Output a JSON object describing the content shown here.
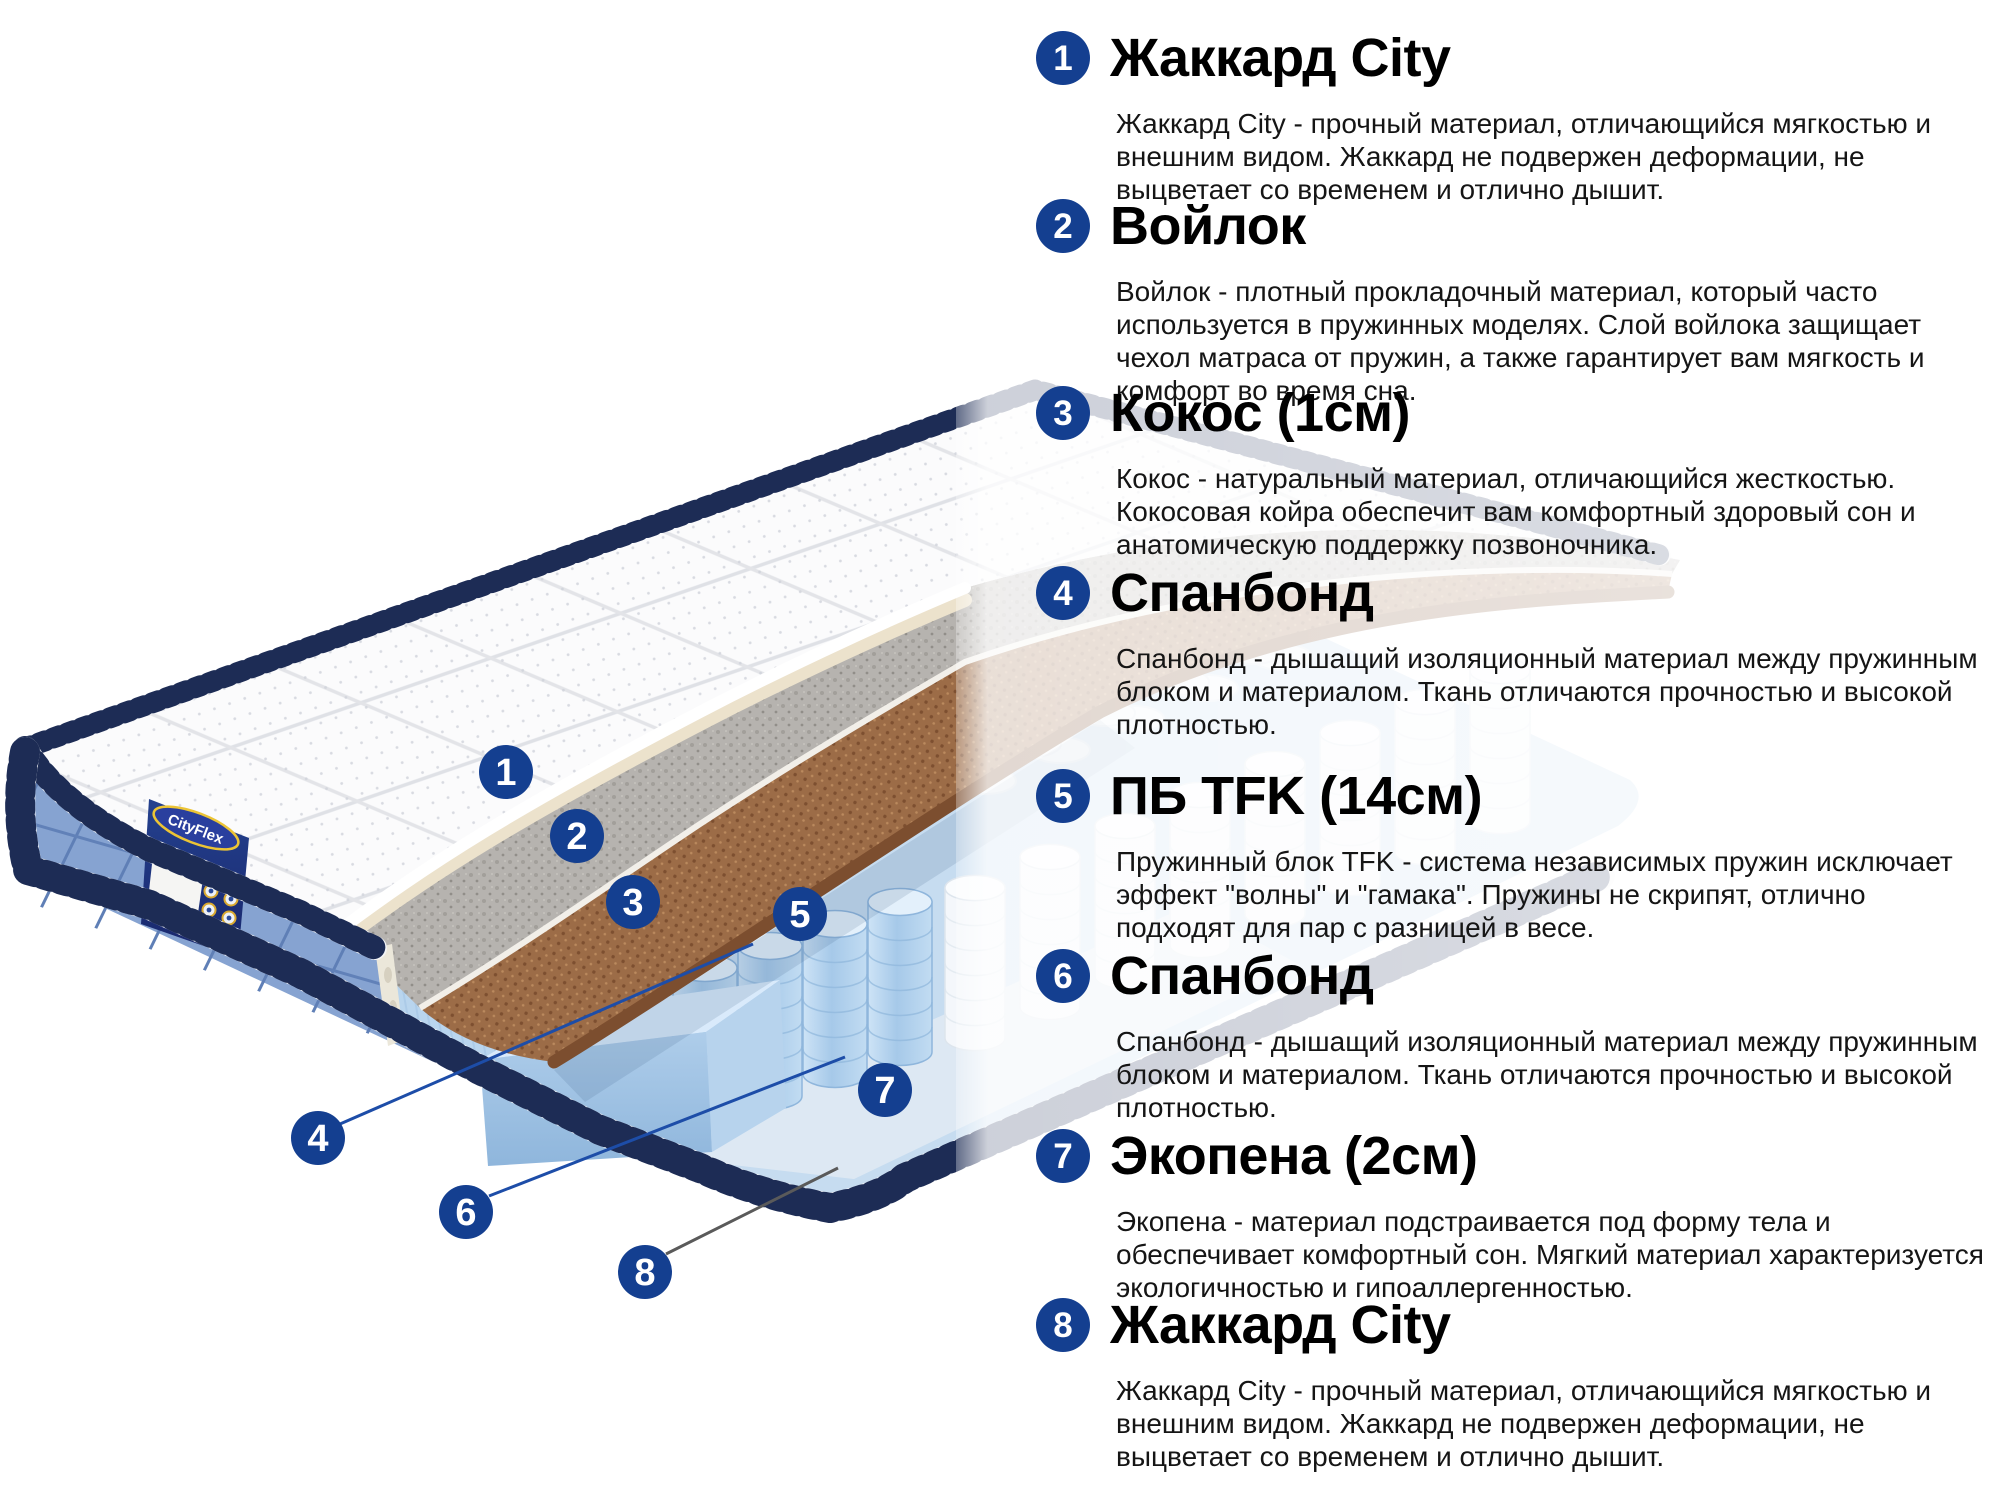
{
  "accent_color": "#143f90",
  "illustration": {
    "brand": "CityFlex",
    "type": "mattress-layer-cutaway",
    "leader_line_blue": "#1d4da8",
    "leader_line_gray": "#5a5a5a",
    "markers": [
      {
        "number": "1",
        "target_layer": "quilted-top-cover"
      },
      {
        "number": "2",
        "target_layer": "felt-layer"
      },
      {
        "number": "3",
        "target_layer": "coconut-coir-layer"
      },
      {
        "number": "4",
        "target_layer": "spunbond-above-springs"
      },
      {
        "number": "5",
        "target_layer": "pocket-spring-block"
      },
      {
        "number": "6",
        "target_layer": "spunbond-below-springs"
      },
      {
        "number": "7",
        "target_layer": "ecofoam-base-layer"
      },
      {
        "number": "8",
        "target_layer": "bottom-jacquard-cover"
      }
    ]
  },
  "legend": {
    "items": [
      {
        "number": "1",
        "title": "Жаккард City",
        "description": "Жаккард City - прочный материал, отличающийся мягкостью и внешним видом. Жаккард не подвержен деформации, не выцветает со временем и отлично дышит."
      },
      {
        "number": "2",
        "title": "Войлок",
        "description": "Войлок - плотный прокладочный материал, который часто используется в пружинных моделях. Слой войлока защищает чехол матраса от пружин, а также гарантирует вам мягкость и комфорт во время сна."
      },
      {
        "number": "3",
        "title": "Кокос (1см)",
        "description": "Кокос - натуральный материал, отличающийся жесткостью. Кокосовая койра обеспечит вам комфортный здоровый сон и анатомическую поддержку позвоночника."
      },
      {
        "number": "4",
        "title": "Спанбонд",
        "description": "Спанбонд - дышащий изоляционный материал между пружинным блоком и материалом. Ткань отличаются прочностью и высокой плотностью."
      },
      {
        "number": "5",
        "title": "ПБ TFK (14см)",
        "description": "Пружинный блок TFK - система независимых пружин исключает эффект \"волны\" и \"гамака\". Пружины не скрипят, отлично подходят для пар с разницей в весе."
      },
      {
        "number": "6",
        "title": "Спанбонд",
        "description": "Спанбонд - дышащий изоляционный материал между пружинным блоком и материалом. Ткань отличаются прочностью и высокой плотностью."
      },
      {
        "number": "7",
        "title": "Экопена (2см)",
        "description": "Экопена - материал подстраивается под форму тела и обеспечивает комфортный сон. Мягкий материал характеризуется экологичностью и гипоаллергенностью."
      },
      {
        "number": "8",
        "title": "Жаккард City",
        "description": "Жаккард City - прочный материал, отличающийся мягкостью и внешним видом. Жаккард не подвержен деформации, не выцветает со временем и отлично дышит."
      }
    ]
  }
}
